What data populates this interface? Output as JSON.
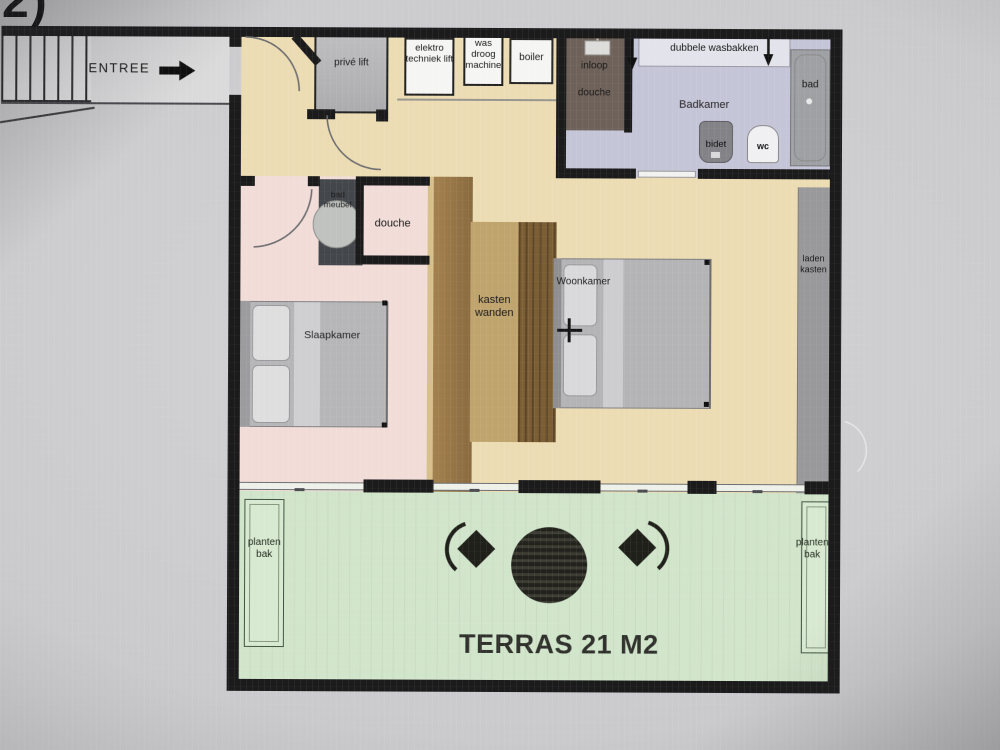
{
  "corner_mark": "2)",
  "corridor": {
    "entree": "ENTREE"
  },
  "rooms": {
    "prive_lift": "privé lift",
    "elektro_techniek_lift": "elektro techniek lift",
    "was_droog_machine": "was droog machine",
    "boiler": "boiler",
    "inloop_douche": "inloop douche",
    "dubbele_wasbakken": "dubbele wasbakken",
    "badkamer": "Badkamer",
    "bad": "bad",
    "bidet": "bidet",
    "wc": "wc",
    "bad_meubel": "bad meubel",
    "douche": "douche",
    "slaapkamer": "Slaapkamer",
    "kasten_wanden": "kasten wanden",
    "woonkamer": "Woonkamer",
    "laden_kasten": "laden kasten",
    "planten_bak": "planten bak",
    "terras": "TERRAS 21 M2"
  },
  "colors": {
    "wall": "#1b1b1c",
    "floor_hall_living": "#eddcb1",
    "floor_bedroom": "#f2dcd8",
    "floor_bathroom": "#c5c5d9",
    "floor_terrace": "#d0e5c9",
    "closet_wood": "#a5814c",
    "walkin_shower": "#6e6159",
    "furniture_gray": "#b5b5b7"
  }
}
